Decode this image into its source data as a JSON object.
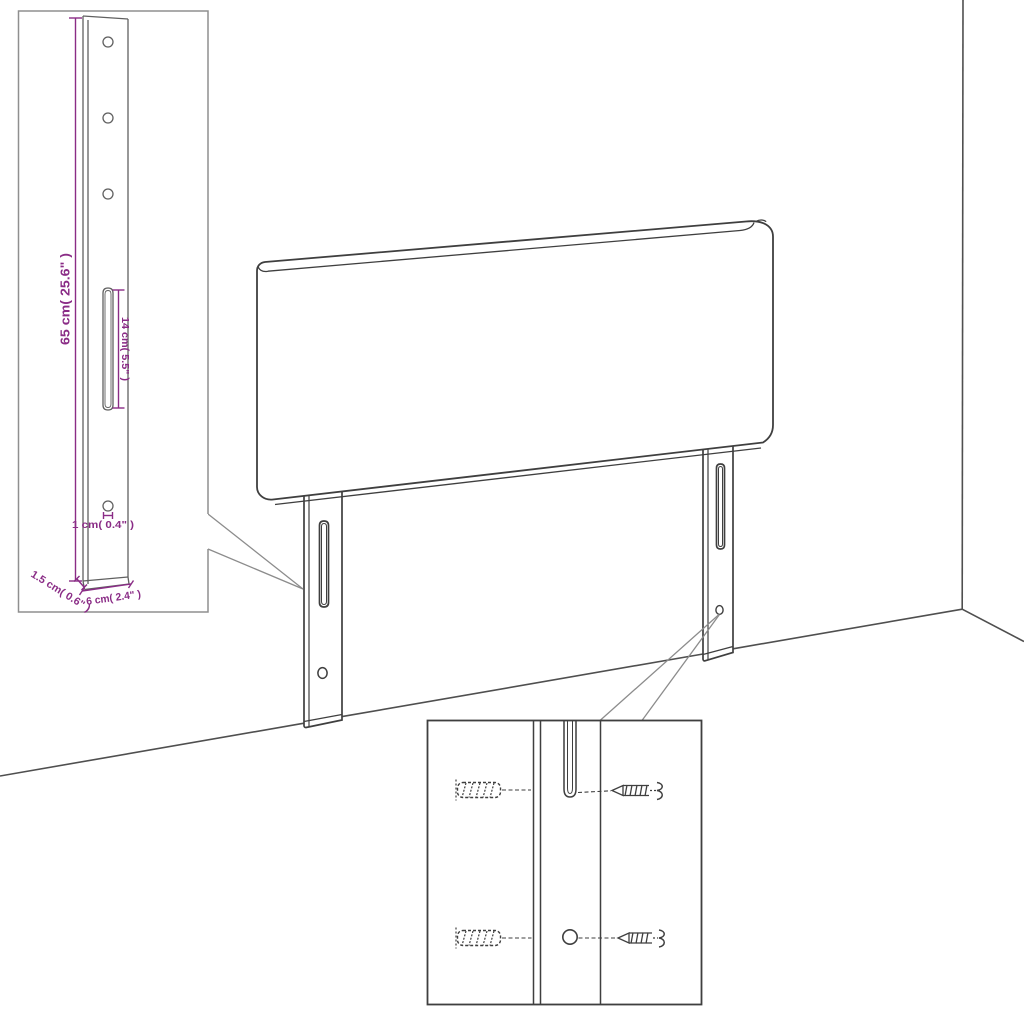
{
  "title": "Headboard with legs — dimension diagram",
  "colors": {
    "background": "#ffffff",
    "outline": "#3f3f3f",
    "scene_line": "#4f4f4f",
    "inset_border": "#8f8f8f",
    "detail_border": "#3f3f3f",
    "dimension": "#8a2c86"
  },
  "inset_leg": {
    "dimensions": {
      "height_label": "65 cm( 25.6\" )",
      "slot_label": "14 cm( 5.5\" )",
      "hole_label": "1 cm( 0.4\" )",
      "side_label": "1.5 cm( 0.6\" )",
      "width_label": "6 cm( 2.4\" )"
    }
  },
  "inset_mounting": {
    "parts": [
      "wall-plug",
      "screw",
      "slot",
      "hole"
    ]
  }
}
